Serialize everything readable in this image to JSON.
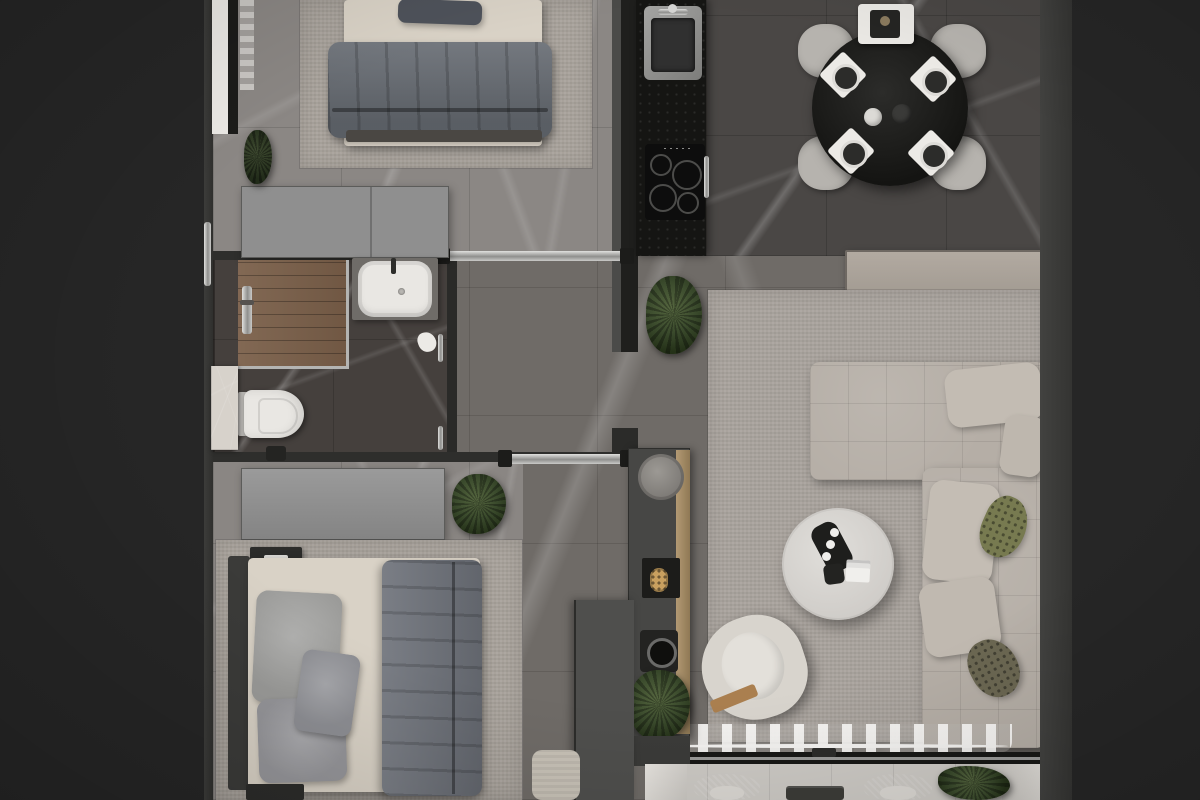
{
  "scene": {
    "description": "Photorealistic top-down 3D render of an apartment floor plan: two bedrooms on the left, bathroom between them, black kitchen counter top-center, round dining table top-right, living room with L-shaped sofa on the right, balcony with wicker chairs along the bottom",
    "view": "top-down orthographic",
    "visible_text": "none",
    "palette": {
      "background_dark": "#262626",
      "wall_dark": "#2e2e2c",
      "wall_mid": "#474745",
      "marble_floor_light": "#8b8784",
      "marble_floor_mid": "#6f6b67",
      "marble_floor_dark": "#45403d",
      "dining_floor_dark": "#4a4745",
      "rug_greige": "#a8a29b",
      "bed_linen_cream": "#d9d2c6",
      "blanket_gray": "#6f737b",
      "wardrobe_gray": "#8f8f8f",
      "kitchen_counter_black": "#151513",
      "dining_table_black": "#1d1d1b",
      "chair_light_gray": "#b6b3ae",
      "sofa_greige": "#b5aea6",
      "pillow_olive": "#777a50",
      "coffee_table_white": "#d8d6d2",
      "armchair_cream": "#d8d4cd",
      "wood_oak": "#a8906c",
      "shower_teak": "#7a5f49",
      "plant_green": "#3a4a2c",
      "chrome": "#c9c9c7",
      "balcony_floor": "#cdcac5",
      "gold_accent": "#c9a05f",
      "toilet_white": "#e9e7e3"
    },
    "rooms": [
      {
        "name": "bedroom-1",
        "position": "top-left",
        "items": [
          "double-bed",
          "dark-pillow",
          "gray-blanket",
          "area-rug",
          "wardrobe",
          "window-sill",
          "sheer-curtain",
          "potted-plant"
        ]
      },
      {
        "name": "bathroom",
        "position": "middle-left",
        "items": [
          "teak-shower-floor",
          "shower-column",
          "washbasin",
          "faucet",
          "toilet",
          "marble-shelf",
          "waste-bin",
          "door-handles",
          "towel"
        ]
      },
      {
        "name": "bedroom-2",
        "position": "bottom-left",
        "items": [
          "double-bed",
          "duvet",
          "three-gray-pillows",
          "headboard",
          "area-rug",
          "wardrobe",
          "nightstand-top",
          "nightstand-bottom"
        ]
      },
      {
        "name": "kitchen",
        "position": "top-center",
        "items": [
          "black-counter",
          "stainless-sink",
          "faucet",
          "induction-cooktop-4-rings",
          "cabinet-handle"
        ]
      },
      {
        "name": "hallway",
        "position": "center",
        "items": [
          "sliding-door-top",
          "sliding-door-middle",
          "console-cabinet",
          "round-tray",
          "gold-remote-shelf",
          "speaker",
          "potted-plants",
          "partition-wall",
          "doormat",
          "wood-trim"
        ]
      },
      {
        "name": "dining-area",
        "position": "top-right",
        "items": [
          "round-black-table",
          "four-gray-chairs",
          "four-place-settings",
          "serving-tray",
          "coffee-maker",
          "salt-pepper-set"
        ]
      },
      {
        "name": "living-room",
        "position": "right",
        "items": [
          "tv-console",
          "marble-sideboard",
          "magazine",
          "coffee-machine",
          "decor-trays",
          "area-rug",
          "l-shaped-sofa",
          "beige-cushions",
          "olive-pillows",
          "round-coffee-table",
          "serving-tray-with-cups",
          "book",
          "remote-box",
          "armchair",
          "potted-plant",
          "sheer-curtain",
          "window-frame"
        ]
      },
      {
        "name": "balcony",
        "position": "bottom",
        "items": [
          "wicker-chair-left",
          "wicker-chair-right",
          "side-table",
          "potted-plant",
          "stone-sills"
        ]
      }
    ]
  }
}
